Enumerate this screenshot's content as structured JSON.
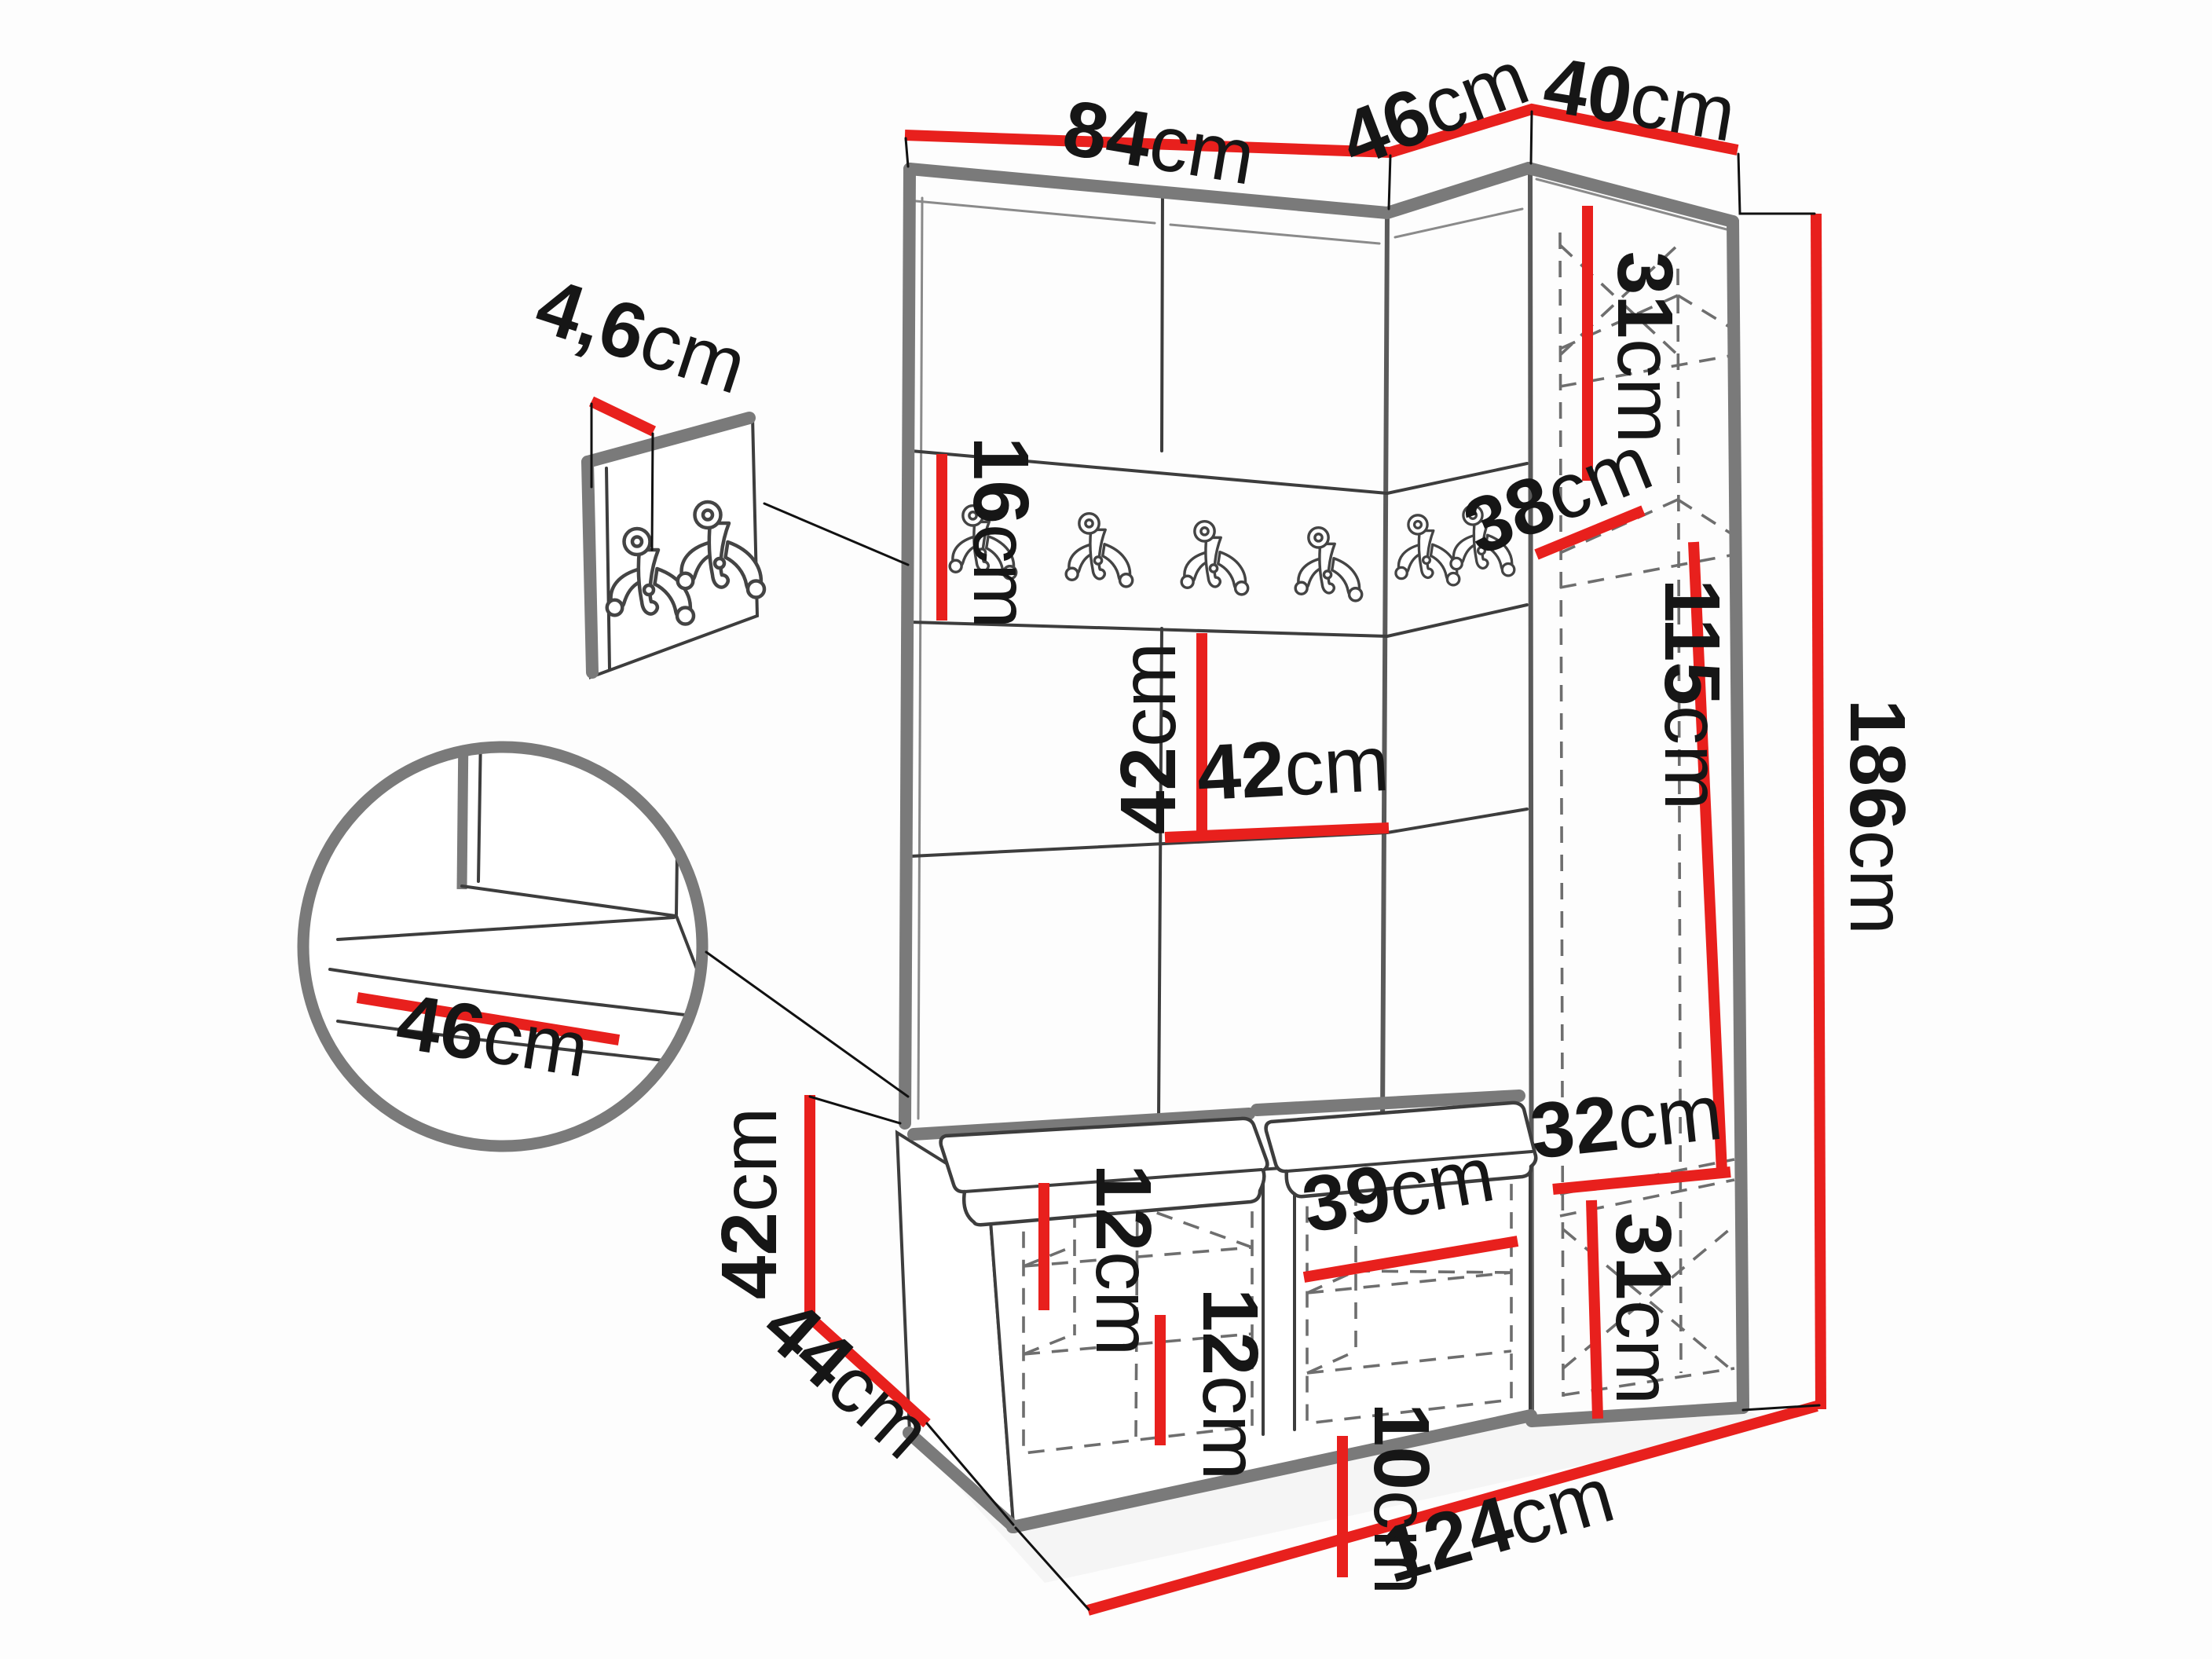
{
  "diagram": {
    "type": "furniture-dimension-diagram",
    "subject": "hallway set: panel wall with hook rail, corner wardrobe and shoe bench",
    "unit": "cm",
    "colors": {
      "dimension_line": "#e8201d",
      "outline": "#7a7a7a",
      "detail_line": "#3d3d3d",
      "text": "#161616",
      "background": "#fdfdfd"
    }
  },
  "dims": {
    "top_main_width": {
      "value": "84",
      "unit": "cm"
    },
    "top_corner_width": {
      "value": "46",
      "unit": "cm"
    },
    "top_wardrobe_width": {
      "value": "40",
      "unit": "cm"
    },
    "wardrobe_top_shelf_height": {
      "value": "31",
      "unit": "cm"
    },
    "wardrobe_shelf_depth": {
      "value": "38",
      "unit": "cm"
    },
    "wardrobe_hanging_height": {
      "value": "115",
      "unit": "cm"
    },
    "total_height": {
      "value": "186",
      "unit": "cm"
    },
    "panel_thickness": {
      "value": "4,6",
      "unit": "cm"
    },
    "hook_rail_height": {
      "value": "16",
      "unit": "cm"
    },
    "panel_height": {
      "value": "42",
      "unit": "cm"
    },
    "panel_width": {
      "value": "42",
      "unit": "cm"
    },
    "seat_depth": {
      "value": "46",
      "unit": "cm"
    },
    "bench_height": {
      "value": "42",
      "unit": "cm"
    },
    "bench_depth": {
      "value": "44",
      "unit": "cm"
    },
    "bench_left_shelf_gap": {
      "value": "12",
      "unit": "cm"
    },
    "bench_mid_shelf_gap": {
      "value": "12",
      "unit": "cm"
    },
    "bench_right_shelf_width": {
      "value": "39",
      "unit": "cm"
    },
    "bench_right_shelf_gap": {
      "value": "10",
      "unit": "cm"
    },
    "wardrobe_bottom_shelf_depth": {
      "value": "32",
      "unit": "cm"
    },
    "wardrobe_bottom_height": {
      "value": "31",
      "unit": "cm"
    },
    "total_width": {
      "value": "124",
      "unit": "cm"
    }
  }
}
